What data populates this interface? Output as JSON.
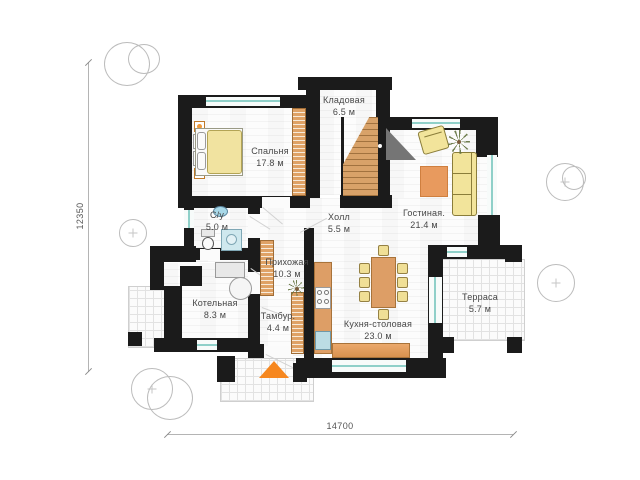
{
  "plan": {
    "rooms": [
      {
        "name": "Спальня",
        "area": "17.8 м"
      },
      {
        "name": "Кладовая",
        "area": "6.5 м"
      },
      {
        "name": "С/у",
        "area": "5.0 м"
      },
      {
        "name": "Холл",
        "area": "5.5 м"
      },
      {
        "name": "Гостиная.",
        "area": "21.4 м"
      },
      {
        "name": "Прихожая",
        "area": "10.3 м"
      },
      {
        "name": "Котельная",
        "area": "8.3 м"
      },
      {
        "name": "Тамбур.",
        "area": "4.4 м"
      },
      {
        "name": "Кухня-столовая",
        "area": "23.0 м"
      },
      {
        "name": "Терраса",
        "area": "5.7 м"
      }
    ],
    "dimensions": {
      "vertical": "12350",
      "horizontal": "14700"
    },
    "colors": {
      "wall": "#1b1b1b",
      "wood": "#dd9e66",
      "upholstery": "#f2e49b",
      "window_glass": "#8fd0c9",
      "entrance_arrow": "#f6871f"
    }
  }
}
